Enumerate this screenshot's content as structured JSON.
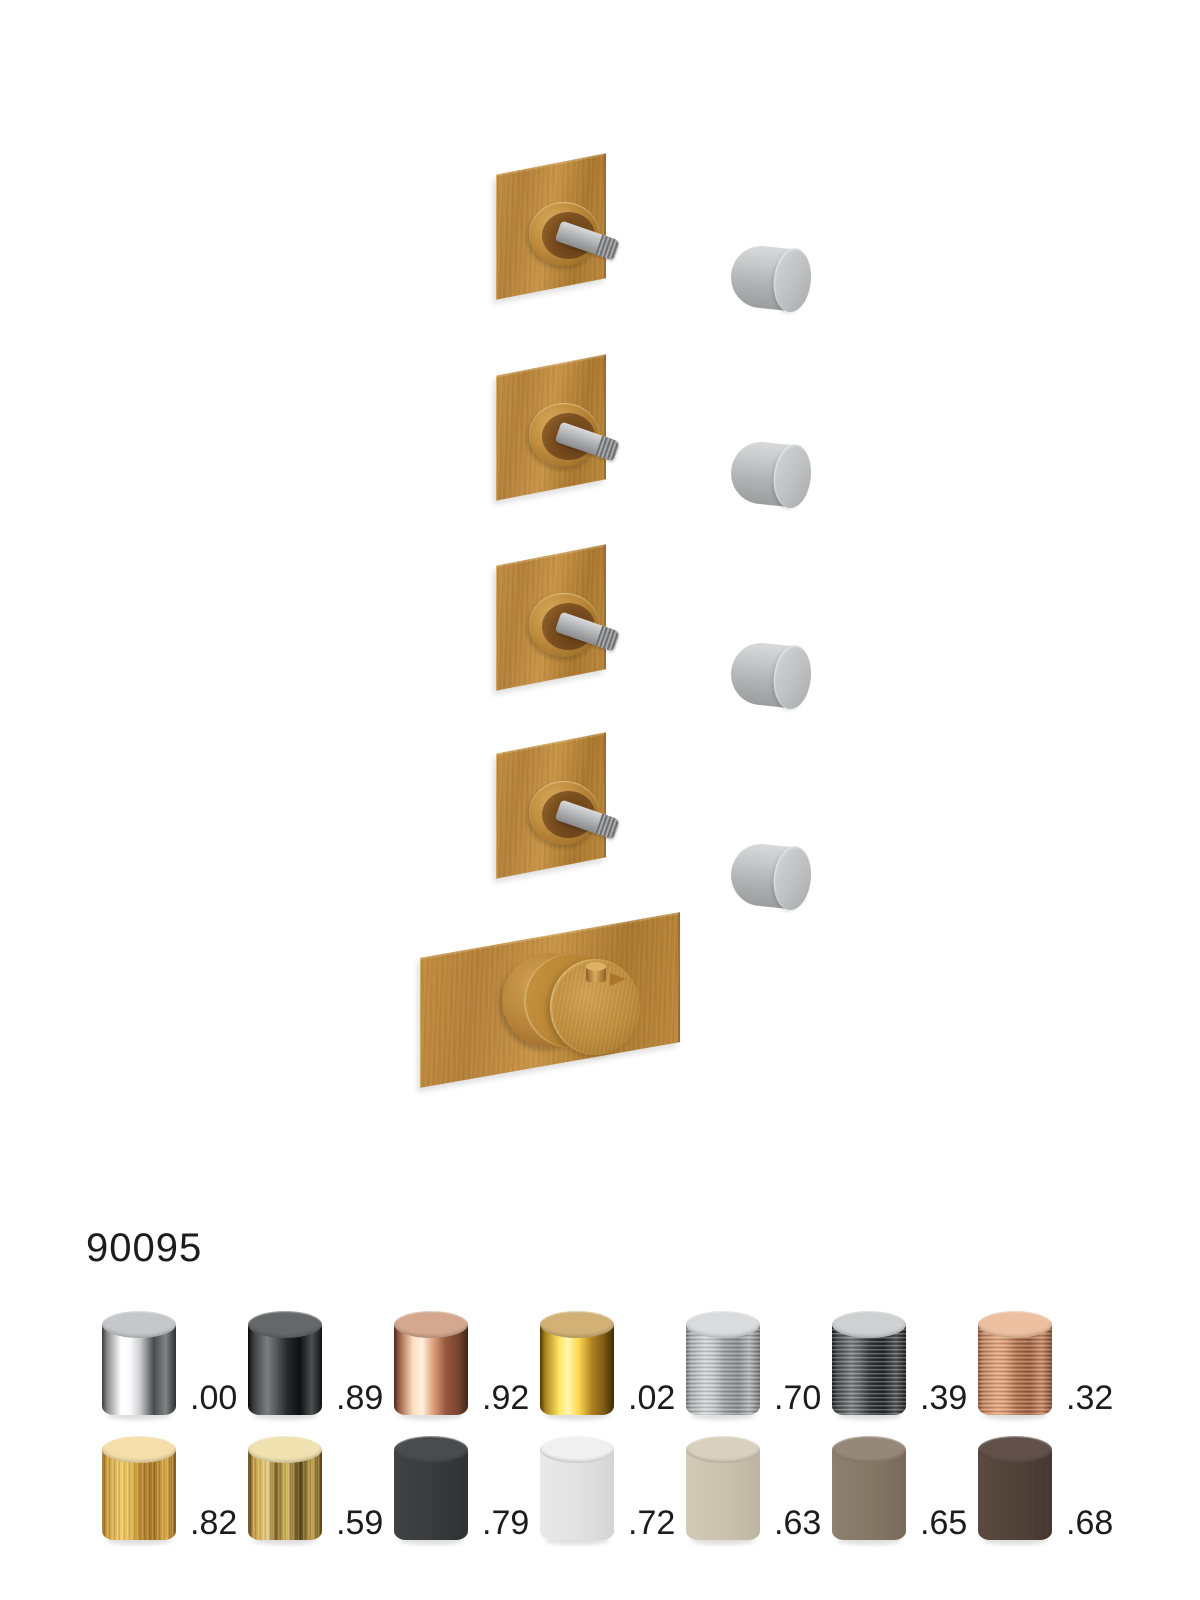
{
  "product": {
    "code": "90095"
  },
  "diagram": {
    "square_trim_count": 4,
    "loose_handle_count": 4,
    "thermostatic_trim_count": 1,
    "plate_color": "#bd883b",
    "collar_bore_color": "#7b4e1f",
    "stem_color": "#a8a9ab",
    "handle_color": "#b9babc"
  },
  "finishes": {
    "per_row": 7,
    "items": [
      {
        "code": ".00",
        "finish": "polished-chrome",
        "style": "polished",
        "texture": "none",
        "top": "#c6c7ca",
        "body": [
          "#3a3a3c",
          "#8a8b8d",
          "#ffffff",
          "#fbfbfd",
          "#c9cacc",
          "#4a4b4d",
          "#818284",
          "#2e2f31"
        ]
      },
      {
        "code": ".89",
        "finish": "polished-black-chrome",
        "style": "polished",
        "texture": "none",
        "top": "#666769",
        "body": [
          "#0a0a0c",
          "#3a3b3d",
          "#7d7e80",
          "#58595b",
          "#2a2b2d",
          "#0e0f11",
          "#4e4f51",
          "#101113"
        ]
      },
      {
        "code": ".92",
        "finish": "polished-rose-gold",
        "style": "polished",
        "texture": "none",
        "top": "#d3a88f",
        "body": [
          "#4a2a1e",
          "#9c6044",
          "#ffdfc2",
          "#fff1e0",
          "#e0a57f",
          "#96573c",
          "#7a4632",
          "#41251b"
        ]
      },
      {
        "code": ".02",
        "finish": "polished-gold",
        "style": "polished",
        "texture": "none",
        "top": "#d2b176",
        "body": [
          "#4a3608",
          "#a8821e",
          "#ffe763",
          "#fff6b0",
          "#ffd84e",
          "#b08322",
          "#7e5c12",
          "#3c2c06"
        ]
      },
      {
        "code": ".70",
        "finish": "brushed-nickel",
        "style": "brushed",
        "texture": "horizontal",
        "top": "#dadbdd",
        "body": [
          "#77787a",
          "#aeafb1",
          "#d6d7d9",
          "#c5c6c8",
          "#9fa0a2",
          "#8a8b8d",
          "#b4b5b7",
          "#737476"
        ]
      },
      {
        "code": ".39",
        "finish": "brushed-gunmetal",
        "style": "brushed",
        "texture": "horizontal",
        "top": "#cfd0d2",
        "body": [
          "#1e1f21",
          "#46474a",
          "#7b7c7e",
          "#5f6062",
          "#333436",
          "#232426",
          "#545557",
          "#212224"
        ]
      },
      {
        "code": ".32",
        "finish": "brushed-copper",
        "style": "brushed",
        "texture": "horizontal",
        "top": "#ecc0a0",
        "body": [
          "#8a5136",
          "#c4805c",
          "#e6a87e",
          "#d99a70",
          "#b26f4b",
          "#9e5f3f",
          "#cc8a63",
          "#80492f"
        ]
      },
      {
        "code": ".82",
        "finish": "brushed-gold",
        "style": "brushed",
        "texture": "vertical",
        "top": "#f4deaa",
        "body": [
          "#96661a",
          "#d3a040",
          "#f2ca66",
          "#e8bb52",
          "#bb882b",
          "#a4751f",
          "#dcae49",
          "#8d5f16"
        ]
      },
      {
        "code": ".59",
        "finish": "brushed-antique-brass",
        "style": "brushed",
        "texture": "vertical",
        "top": "#efe2b0",
        "body": [
          "#43300c",
          "#c49b42",
          "#ead283",
          "#7e611c",
          "#d9bc62",
          "#52400f",
          "#c7a74b",
          "#5e4813"
        ]
      },
      {
        "code": ".79",
        "finish": "matte-black",
        "style": "matte",
        "texture": "none",
        "top": "#4a4b4e",
        "body": [
          "#414245",
          "#3a3b3e",
          "#303134"
        ]
      },
      {
        "code": ".72",
        "finish": "matte-white",
        "style": "matte",
        "texture": "none",
        "top": "#f0f0f0",
        "body": [
          "#e9e9e9",
          "#e2e2e2",
          "#d5d5d5"
        ]
      },
      {
        "code": ".63",
        "finish": "matte-greige",
        "style": "matte",
        "texture": "none",
        "top": "#d9d1c0",
        "body": [
          "#d2c9b6",
          "#cbc2af",
          "#bdb4a1"
        ]
      },
      {
        "code": ".65",
        "finish": "matte-taupe",
        "style": "matte",
        "texture": "none",
        "top": "#968878",
        "body": [
          "#8e8071",
          "#867867",
          "#776a5b"
        ]
      },
      {
        "code": ".68",
        "finish": "matte-dark-brown",
        "style": "matte",
        "texture": "none",
        "top": "#61514a",
        "body": [
          "#5a4a41",
          "#52433a",
          "#453830"
        ]
      }
    ]
  }
}
